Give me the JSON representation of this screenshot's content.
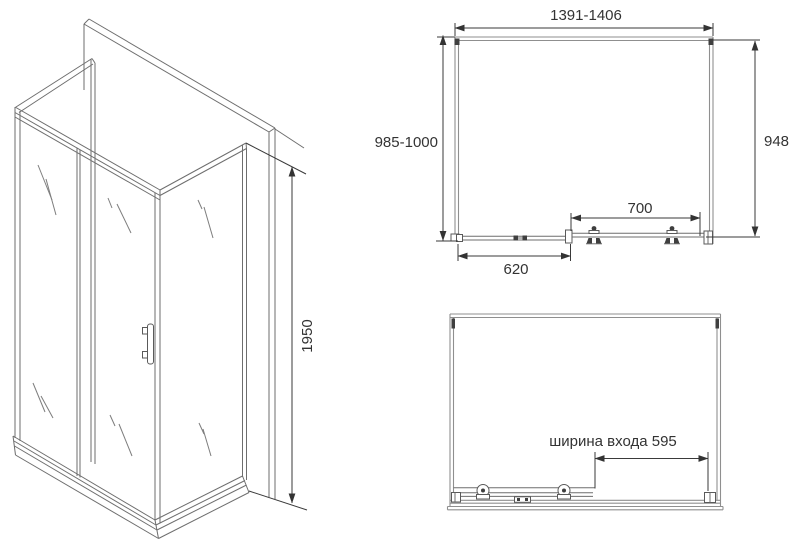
{
  "title": "shower-enclosure-technical-drawing",
  "colors": {
    "background": "#ffffff",
    "outline": "#6e6e6e",
    "profile": "#8f8f8f",
    "dimension": "#3a3a3a",
    "text": "#333333",
    "dark_detail": "#3f3f3f"
  },
  "views": {
    "iso": {
      "height_dim": "1950"
    },
    "plan": {
      "width_dim": "1391-1406",
      "depth_dim": "985-1000",
      "side_dim": "948",
      "track_dim": "700",
      "door_dim": "620"
    },
    "front": {
      "entrance_dim": "ширина входа 595"
    }
  }
}
